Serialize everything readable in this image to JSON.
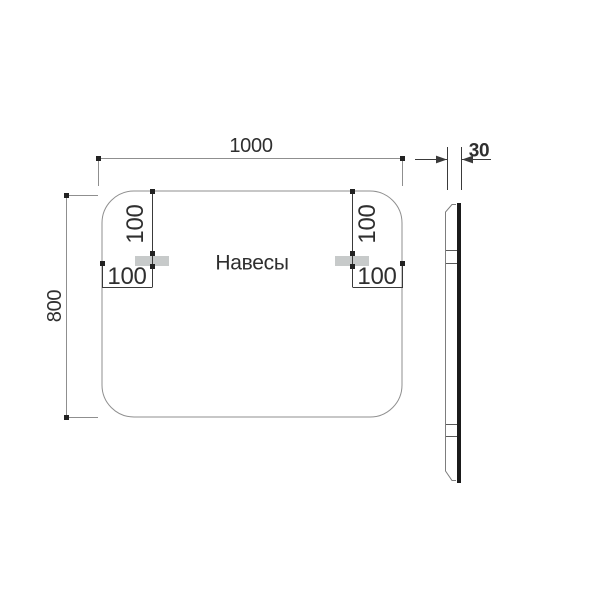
{
  "front_view": {
    "width_label": "1000",
    "height_label": "800",
    "hangers_caption": "Навесы",
    "left_hanger": {
      "top_offset_label": "100",
      "side_offset_label": "100"
    },
    "right_hanger": {
      "top_offset_label": "100",
      "side_offset_label": "100"
    }
  },
  "side_view": {
    "thickness_label": "30"
  },
  "colors": {
    "background": "#ffffff",
    "line": "#8f8f8f",
    "text": "#2f2f2f",
    "thick_edge": "#1b1b1b",
    "endpoint_dot": "#222222",
    "hanger_fill": "#c7caca"
  }
}
